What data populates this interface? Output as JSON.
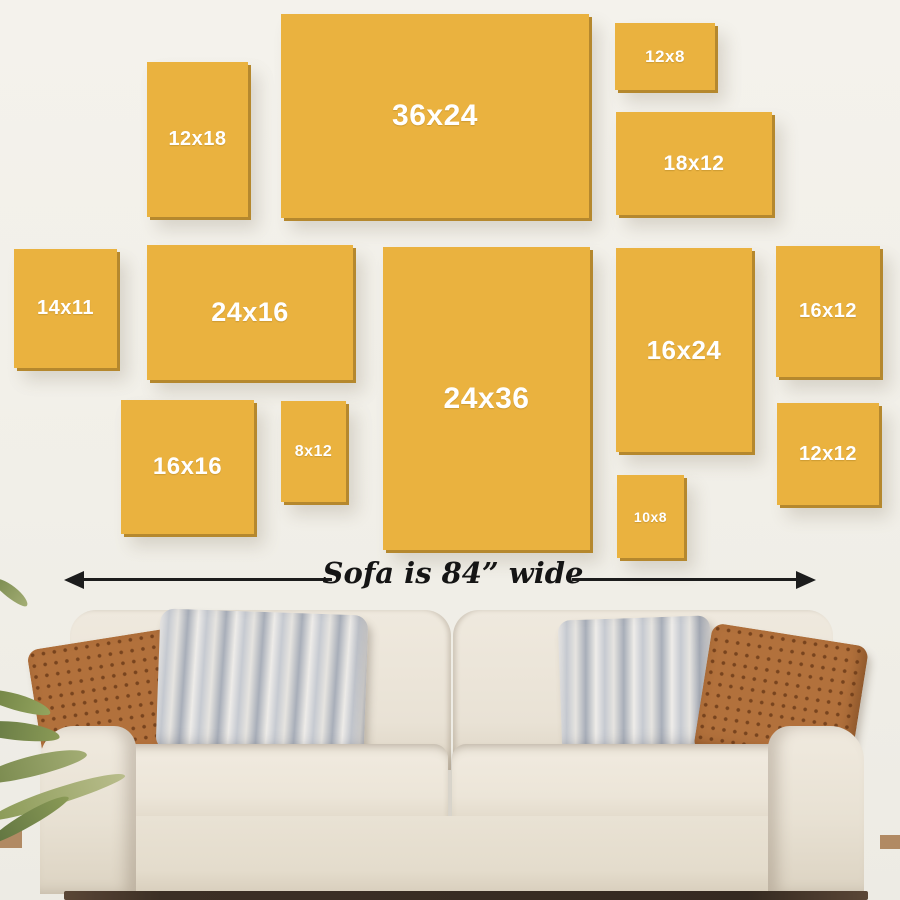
{
  "scene": {
    "description_label": "Wall art size guide above sofa",
    "sofa_width_label": "Sofa is 84” wide"
  },
  "colors": {
    "frame_fill": "#eab23f",
    "frame_edge_shadow": "#b5882e",
    "frame_label_text": "#ffffff",
    "wall": "#f1efe8",
    "arrow": "#1c1c1c",
    "sofa_fabric": "#ece6db",
    "pillow_brown": "#b2713c",
    "pillow_stripe_gray": "#a8aeb9"
  },
  "frames": [
    {
      "label": "12x18",
      "x": 147,
      "y": 62,
      "w": 101,
      "h": 155,
      "fs": 20
    },
    {
      "label": "36x24",
      "x": 281,
      "y": 14,
      "w": 308,
      "h": 204,
      "fs": 30
    },
    {
      "label": "12x8",
      "x": 615,
      "y": 23,
      "w": 100,
      "h": 67,
      "fs": 17
    },
    {
      "label": "18x12",
      "x": 616,
      "y": 112,
      "w": 156,
      "h": 103,
      "fs": 21
    },
    {
      "label": "14x11",
      "x": 14,
      "y": 249,
      "w": 103,
      "h": 119,
      "fs": 20
    },
    {
      "label": "24x16",
      "x": 147,
      "y": 245,
      "w": 206,
      "h": 135,
      "fs": 27
    },
    {
      "label": "24x36",
      "x": 383,
      "y": 247,
      "w": 207,
      "h": 303,
      "fs": 30
    },
    {
      "label": "16x24",
      "x": 616,
      "y": 248,
      "w": 136,
      "h": 204,
      "fs": 26
    },
    {
      "label": "16x12",
      "x": 776,
      "y": 246,
      "w": 104,
      "h": 131,
      "fs": 20
    },
    {
      "label": "16x16",
      "x": 121,
      "y": 400,
      "w": 133,
      "h": 134,
      "fs": 24
    },
    {
      "label": "8x12",
      "x": 281,
      "y": 401,
      "w": 65,
      "h": 101,
      "fs": 16
    },
    {
      "label": "10x8",
      "x": 617,
      "y": 475,
      "w": 67,
      "h": 83,
      "fs": 14
    },
    {
      "label": "12x12",
      "x": 777,
      "y": 403,
      "w": 102,
      "h": 102,
      "fs": 20
    }
  ],
  "arrow": {
    "left_tip_x": 64,
    "right_tip_x": 816,
    "y": 579,
    "left_segment": {
      "x": 80,
      "w": 252
    },
    "right_segment": {
      "x": 572,
      "w": 228
    }
  }
}
